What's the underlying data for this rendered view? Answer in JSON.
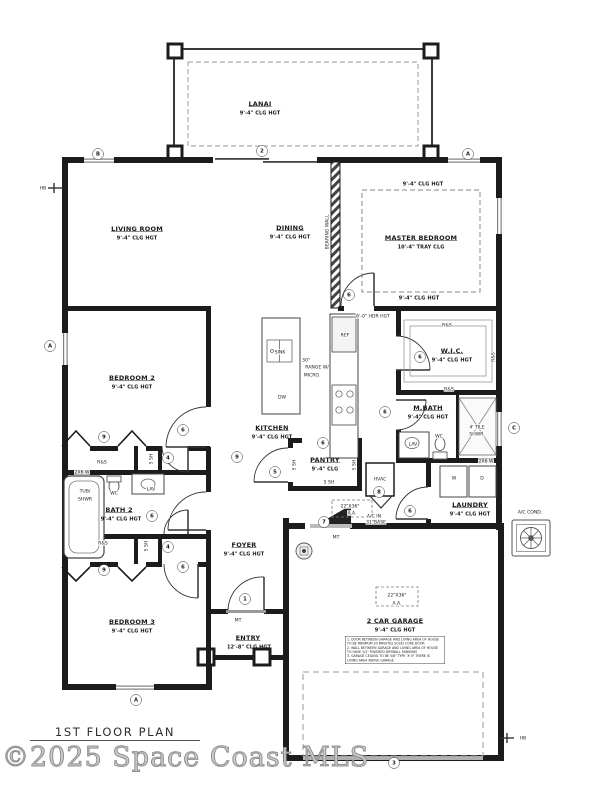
{
  "page": {
    "title": "1ST FLOOR PLAN",
    "watermark": "©2025 Space Coast MLS"
  },
  "plan": {
    "labels": [
      {
        "t": "LANAI",
        "x": 260,
        "y": 104,
        "c": "room"
      },
      {
        "t": "9'-4\" CLG HGT",
        "x": 260,
        "y": 113,
        "c": "sub"
      },
      {
        "t": "LIVING ROOM",
        "x": 137,
        "y": 229,
        "c": "room"
      },
      {
        "t": "9'-4\" CLG HGT",
        "x": 137,
        "y": 238,
        "c": "sub"
      },
      {
        "t": "DINING",
        "x": 290,
        "y": 228,
        "c": "room"
      },
      {
        "t": "9'-4\" CLG HGT",
        "x": 290,
        "y": 237,
        "c": "sub"
      },
      {
        "t": "MASTER BEDROOM",
        "x": 421,
        "y": 238,
        "c": "room"
      },
      {
        "t": "10'-4\" TRAY CLG",
        "x": 421,
        "y": 247,
        "c": "sub"
      },
      {
        "t": "9'-4\" CLG HGT",
        "x": 423,
        "y": 184,
        "c": "sub"
      },
      {
        "t": "9'-4\" CLG HGT",
        "x": 419,
        "y": 298,
        "c": "sub"
      },
      {
        "t": "BEARING WALL",
        "x": 327,
        "y": 232,
        "c": "vert"
      },
      {
        "t": "W.I.C.",
        "x": 452,
        "y": 351,
        "c": "room"
      },
      {
        "t": "9'-4\" CLG HGT",
        "x": 452,
        "y": 360,
        "c": "sub"
      },
      {
        "t": "BEDROOM 2",
        "x": 132,
        "y": 378,
        "c": "room"
      },
      {
        "t": "9'-4\" CLG HGT",
        "x": 132,
        "y": 387,
        "c": "sub"
      },
      {
        "t": "M.BATH",
        "x": 428,
        "y": 408,
        "c": "room"
      },
      {
        "t": "9'-4\" CLG HGT",
        "x": 428,
        "y": 417,
        "c": "sub"
      },
      {
        "t": "KITCHEN",
        "x": 272,
        "y": 428,
        "c": "room"
      },
      {
        "t": "9'-4\" CLG HGT",
        "x": 272,
        "y": 437,
        "c": "sub"
      },
      {
        "t": "PANTRY",
        "x": 325,
        "y": 460,
        "c": "room"
      },
      {
        "t": "9'-4\" CLG",
        "x": 325,
        "y": 469,
        "c": "sub"
      },
      {
        "t": "BATH 2",
        "x": 119,
        "y": 510,
        "c": "room"
      },
      {
        "t": "9'-4\" CLG HGT",
        "x": 121,
        "y": 519,
        "c": "sub"
      },
      {
        "t": "LAUNDRY",
        "x": 470,
        "y": 505,
        "c": "room"
      },
      {
        "t": "9'-4\" CLG HGT",
        "x": 470,
        "y": 514,
        "c": "sub"
      },
      {
        "t": "FOYER",
        "x": 244,
        "y": 545,
        "c": "room"
      },
      {
        "t": "9'-4\" CLG HGT",
        "x": 244,
        "y": 554,
        "c": "sub"
      },
      {
        "t": "BEDROOM 3",
        "x": 132,
        "y": 622,
        "c": "room"
      },
      {
        "t": "9'-4\" CLG HGT",
        "x": 132,
        "y": 631,
        "c": "sub"
      },
      {
        "t": "ENTRY",
        "x": 248,
        "y": 638,
        "c": "room"
      },
      {
        "t": "12'-8\" CLG HGT",
        "x": 249,
        "y": 647,
        "c": "sub"
      },
      {
        "t": "2 CAR GARAGE",
        "x": 395,
        "y": 621,
        "c": "room"
      },
      {
        "t": "9'-4\" CLG HGT",
        "x": 395,
        "y": 630,
        "c": "sub"
      },
      {
        "t": "6'-0\" HDR HGT",
        "x": 373,
        "y": 316,
        "c": "tiny"
      },
      {
        "t": "R&S",
        "x": 447,
        "y": 325,
        "c": "tiny"
      },
      {
        "t": "R&S",
        "x": 493,
        "y": 357,
        "c": "vert"
      },
      {
        "t": "R&S",
        "x": 449,
        "y": 389,
        "c": "tiny"
      },
      {
        "t": "REF",
        "x": 345,
        "y": 335,
        "c": "tiny"
      },
      {
        "t": "SINK",
        "x": 280,
        "y": 352,
        "c": "tiny"
      },
      {
        "t": "DW",
        "x": 282,
        "y": 397,
        "c": "tiny"
      },
      {
        "t": "30\"",
        "x": 306,
        "y": 360,
        "c": "tiny"
      },
      {
        "t": "RANGE W/",
        "x": 317,
        "y": 367,
        "c": "tiny"
      },
      {
        "t": "MICRO.",
        "x": 312,
        "y": 375,
        "c": "tiny"
      },
      {
        "t": "LAV",
        "x": 413,
        "y": 444,
        "c": "tiny"
      },
      {
        "t": "WC",
        "x": 439,
        "y": 436,
        "c": "tiny"
      },
      {
        "t": "4' TILE",
        "x": 477,
        "y": 427,
        "c": "tiny"
      },
      {
        "t": "SHWR.",
        "x": 477,
        "y": 434,
        "c": "tiny"
      },
      {
        "t": "2X6 W",
        "x": 486,
        "y": 461,
        "c": "tiny"
      },
      {
        "t": "W",
        "x": 454,
        "y": 478,
        "c": "tiny"
      },
      {
        "t": "D",
        "x": 482,
        "y": 478,
        "c": "tiny"
      },
      {
        "t": "HVAC",
        "x": 380,
        "y": 479,
        "c": "tiny"
      },
      {
        "t": "22\"X36\"",
        "x": 350,
        "y": 506,
        "c": "tiny"
      },
      {
        "t": "A.A.",
        "x": 352,
        "y": 513,
        "c": "tiny"
      },
      {
        "t": "A/C IN",
        "x": 374,
        "y": 516,
        "c": "tiny"
      },
      {
        "t": "31\"BASE",
        "x": 376,
        "y": 522,
        "c": "tiny"
      },
      {
        "t": "MT",
        "x": 336,
        "y": 537,
        "c": "tiny"
      },
      {
        "t": "MT",
        "x": 238,
        "y": 620,
        "c": "tiny"
      },
      {
        "t": "22\"X36\"",
        "x": 397,
        "y": 595,
        "c": "tiny"
      },
      {
        "t": "A.A.",
        "x": 397,
        "y": 603,
        "c": "tiny"
      },
      {
        "t": "5 SH",
        "x": 151,
        "y": 459,
        "c": "vert"
      },
      {
        "t": "5 SH",
        "x": 146,
        "y": 546,
        "c": "vert"
      },
      {
        "t": "5 SH",
        "x": 294,
        "y": 465,
        "c": "vert"
      },
      {
        "t": "5 SH",
        "x": 354,
        "y": 465,
        "c": "vert"
      },
      {
        "t": "5 SH",
        "x": 329,
        "y": 482,
        "c": "tiny"
      },
      {
        "t": "R&S",
        "x": 102,
        "y": 462,
        "c": "tiny"
      },
      {
        "t": "R&S",
        "x": 103,
        "y": 543,
        "c": "tiny"
      },
      {
        "t": "2X6 W",
        "x": 82,
        "y": 472,
        "c": "tiny"
      },
      {
        "t": "TUB/",
        "x": 85,
        "y": 491,
        "c": "tiny"
      },
      {
        "t": "SHWR",
        "x": 85,
        "y": 499,
        "c": "tiny"
      },
      {
        "t": "WC",
        "x": 114,
        "y": 493,
        "c": "tiny"
      },
      {
        "t": "LAV",
        "x": 151,
        "y": 489,
        "c": "tiny"
      },
      {
        "t": "A/C COND.",
        "x": 530,
        "y": 512,
        "c": "tiny"
      },
      {
        "t": "HB",
        "x": 43,
        "y": 188,
        "c": "tiny"
      },
      {
        "t": "HB",
        "x": 523,
        "y": 738,
        "c": "tiny"
      }
    ],
    "markers": [
      {
        "t": "B",
        "x": 98,
        "y": 154
      },
      {
        "t": "2",
        "x": 262,
        "y": 151
      },
      {
        "t": "A",
        "x": 468,
        "y": 154
      },
      {
        "t": "A",
        "x": 50,
        "y": 346
      },
      {
        "t": "C",
        "x": 514,
        "y": 428
      },
      {
        "t": "A",
        "x": 136,
        "y": 700
      },
      {
        "t": "3",
        "x": 394,
        "y": 763
      },
      {
        "t": "6",
        "x": 349,
        "y": 295
      },
      {
        "t": "6",
        "x": 420,
        "y": 357
      },
      {
        "t": "6",
        "x": 385,
        "y": 412
      },
      {
        "t": "6",
        "x": 323,
        "y": 443
      },
      {
        "t": "9",
        "x": 237,
        "y": 457
      },
      {
        "t": "5",
        "x": 275,
        "y": 472
      },
      {
        "t": "4",
        "x": 168,
        "y": 458
      },
      {
        "t": "6",
        "x": 183,
        "y": 430
      },
      {
        "t": "9",
        "x": 104,
        "y": 437
      },
      {
        "t": "6",
        "x": 152,
        "y": 516
      },
      {
        "t": "4",
        "x": 168,
        "y": 547
      },
      {
        "t": "9",
        "x": 104,
        "y": 570
      },
      {
        "t": "6",
        "x": 183,
        "y": 567
      },
      {
        "t": "8",
        "x": 379,
        "y": 492
      },
      {
        "t": "6",
        "x": 410,
        "y": 511
      },
      {
        "t": "7",
        "x": 324,
        "y": 522
      },
      {
        "t": "1",
        "x": 245,
        "y": 599
      }
    ],
    "garage_notes": [
      "1. DOOR BETWEEN GARAGE AND LIVING AREA OF HOUSE",
      "   TO BE MINIMUM 20 MINUTES SOLID CORE DOOR",
      "2. WALL BETWEEN GARAGE AND LIVING AREA OF HOUSE",
      "   TO HAVE 1/2\" FINISHED DRYWALL MINIMUM",
      "3. GARAGE CEILING TO BE 5/8\" TYPE 'X' IF THERE IS",
      "   LIVING AREA ABOVE GARAGE"
    ]
  }
}
